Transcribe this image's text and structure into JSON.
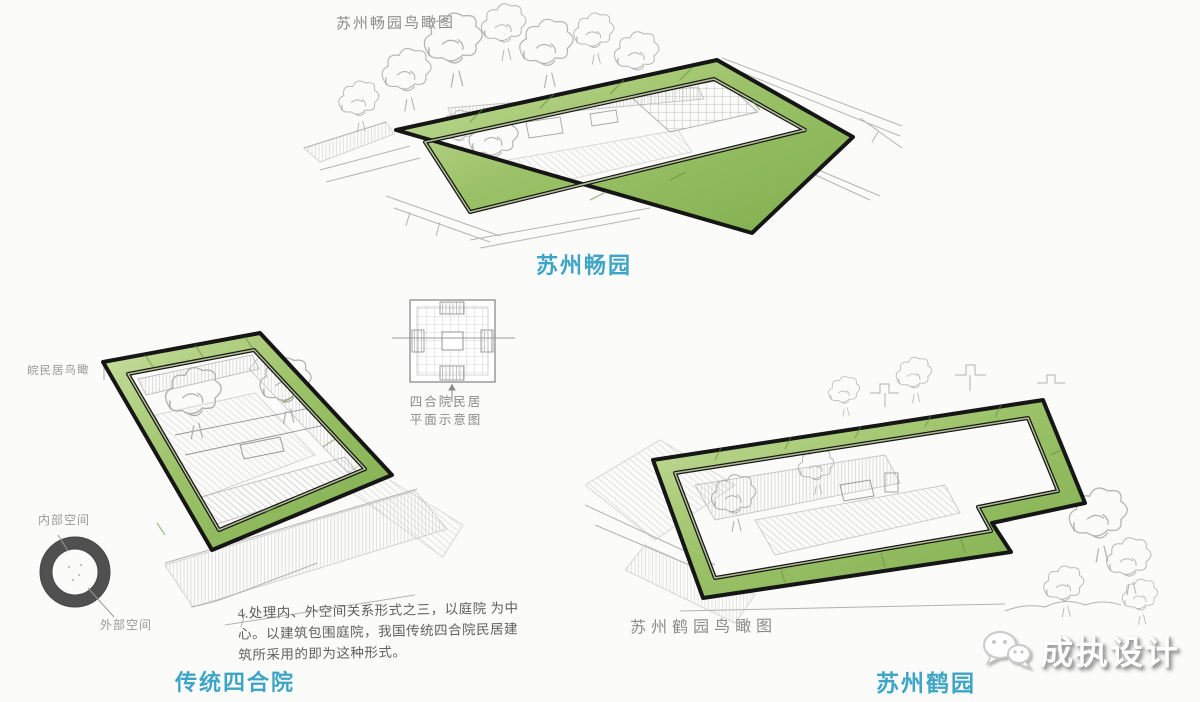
{
  "colors": {
    "background": "#fbfbf9",
    "caption_blue": "#3fa5c6",
    "ring_green_light": "#c9e0a0",
    "ring_green_dark": "#7fae4e",
    "ring_outline": "#161616",
    "sketch_gray": "#a5a5a5",
    "label_gray": "#8b8b8b",
    "space_ring_gray": "#474747"
  },
  "figures": {
    "changyuan": {
      "sketch_label": "苏州畅园鸟瞰图",
      "caption": "苏州畅园"
    },
    "siheyuan": {
      "sketch_label": "皖民居鸟瞰",
      "caption": "传统四合院",
      "plan_caption": [
        "四合院民居",
        "平面示意图"
      ],
      "space_diagram": {
        "inner_label": "内部空间",
        "outer_label": "外部空间"
      },
      "note_lines": [
        "4.处理内、外空间关系形式之三，以庭院 为中",
        "心。以建筑包围庭院，我国传统四合院民居建",
        "筑所采用的即为这种形式。"
      ]
    },
    "heyuan": {
      "sketch_label": "苏州鹤园鸟瞰图",
      "caption": "苏州鹤园"
    }
  },
  "watermark": {
    "brand": "成执设计",
    "logo": "wechat-logo"
  }
}
